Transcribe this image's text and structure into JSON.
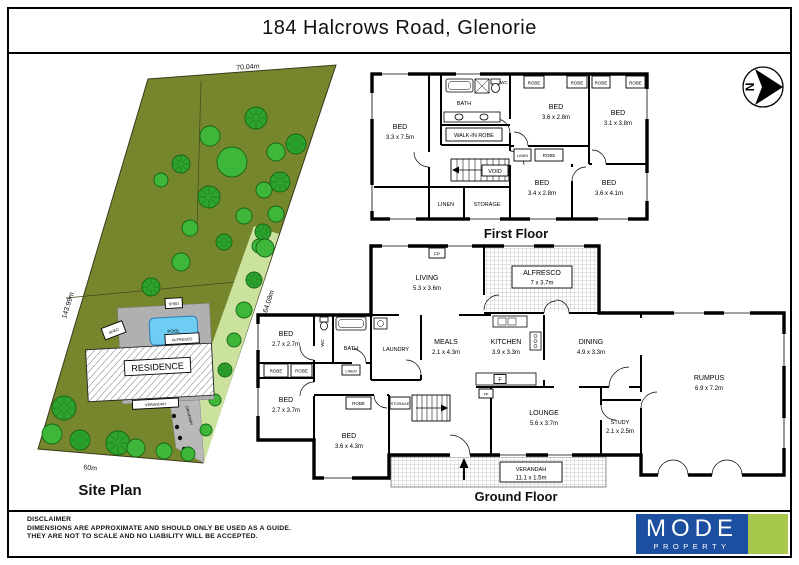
{
  "title": "184 Halcrows Road, Glenorie",
  "north": {
    "label": "N"
  },
  "site": {
    "caption": "Site Plan",
    "dim_top": "70.04m",
    "dim_left": "143.99m",
    "dim_right": "164.08m",
    "dim_bottom": "60m",
    "residence": "RESIDENCE",
    "pool": "POOL",
    "alfresco": "ALFRESCO",
    "verandah": "VERANDAH",
    "shed": "SHED",
    "driveway": "DRIVEWAY"
  },
  "ff": {
    "caption": "First Floor",
    "bed1_name": "BED",
    "bed1_dims": "3.3 x 7.5m",
    "bed2_name": "BED",
    "bed2_dims": "3.6 x 2.8m",
    "bed3_name": "BED",
    "bed3_dims": "3.1 x 3.8m",
    "bed4_name": "BED",
    "bed4_dims": "3.4 x 2.8m",
    "bed5_name": "BED",
    "bed5_dims": "3.6 x 4.1m",
    "bath": "BATH",
    "wc": "WC",
    "wir": "WALK-IN ROBE",
    "robe": "ROBE",
    "void": "VOID",
    "linen": "LINEN",
    "storage": "STORAGE"
  },
  "gf": {
    "caption": "Ground Floor",
    "living_name": "LIVING",
    "living_dims": "5.3 x 3.6m",
    "alfresco_name": "ALFRESCO",
    "alfresco_dims": "7 x 3.7m",
    "bed1_name": "BED",
    "bed1_dims": "2.7 x 2.7m",
    "bed2_name": "BED",
    "bed2_dims": "2.7 x 3.7m",
    "bed3_name": "BED",
    "bed3_dims": "3.6 x 4.3m",
    "meals_name": "MEALS",
    "meals_dims": "2.1 x 4.3m",
    "kitchen_name": "KITCHEN",
    "kitchen_dims": "3.9 x 3.3m",
    "dining_name": "DINING",
    "dining_dims": "4.9 x 3.3m",
    "lounge_name": "LOUNGE",
    "lounge_dims": "5.6 x 3.7m",
    "study_name": "STUDY",
    "study_dims": "2.1 x 2.5m",
    "rumpus_name": "RUMPUS",
    "rumpus_dims": "6.9 x 7.2m",
    "verandah_name": "VERANDAH",
    "verandah_dims": "11.1 x 1.5m",
    "wc": "WC",
    "bath": "BATH",
    "laundry": "LAUNDRY",
    "robe": "ROBE",
    "linen": "LINEN",
    "storage": "STORAGE",
    "fp": "FP",
    "fridge": "F"
  },
  "footer": {
    "disclaimer_title": "DISCLAIMER",
    "line1": "DIMENSIONS ARE APPROXIMATE AND SHOULD ONLY BE USED AS A GUIDE.",
    "line2": "THEY ARE NOT TO SCALE AND NO LIABILITY WILL BE ACCEPTED.",
    "logo_name": "MODE",
    "logo_sub": "PROPERTY"
  },
  "colors": {
    "parcel": "#75862c",
    "tree": "#3eb63a",
    "tree_dark": "#2da32d",
    "garden": "#cbe29f",
    "paving": "#b0b0b0",
    "driveway": "#b9b9b9",
    "pool": "#6fcdf4",
    "logo_blue": "#1d4fa0",
    "logo_green": "#a6c84d"
  }
}
